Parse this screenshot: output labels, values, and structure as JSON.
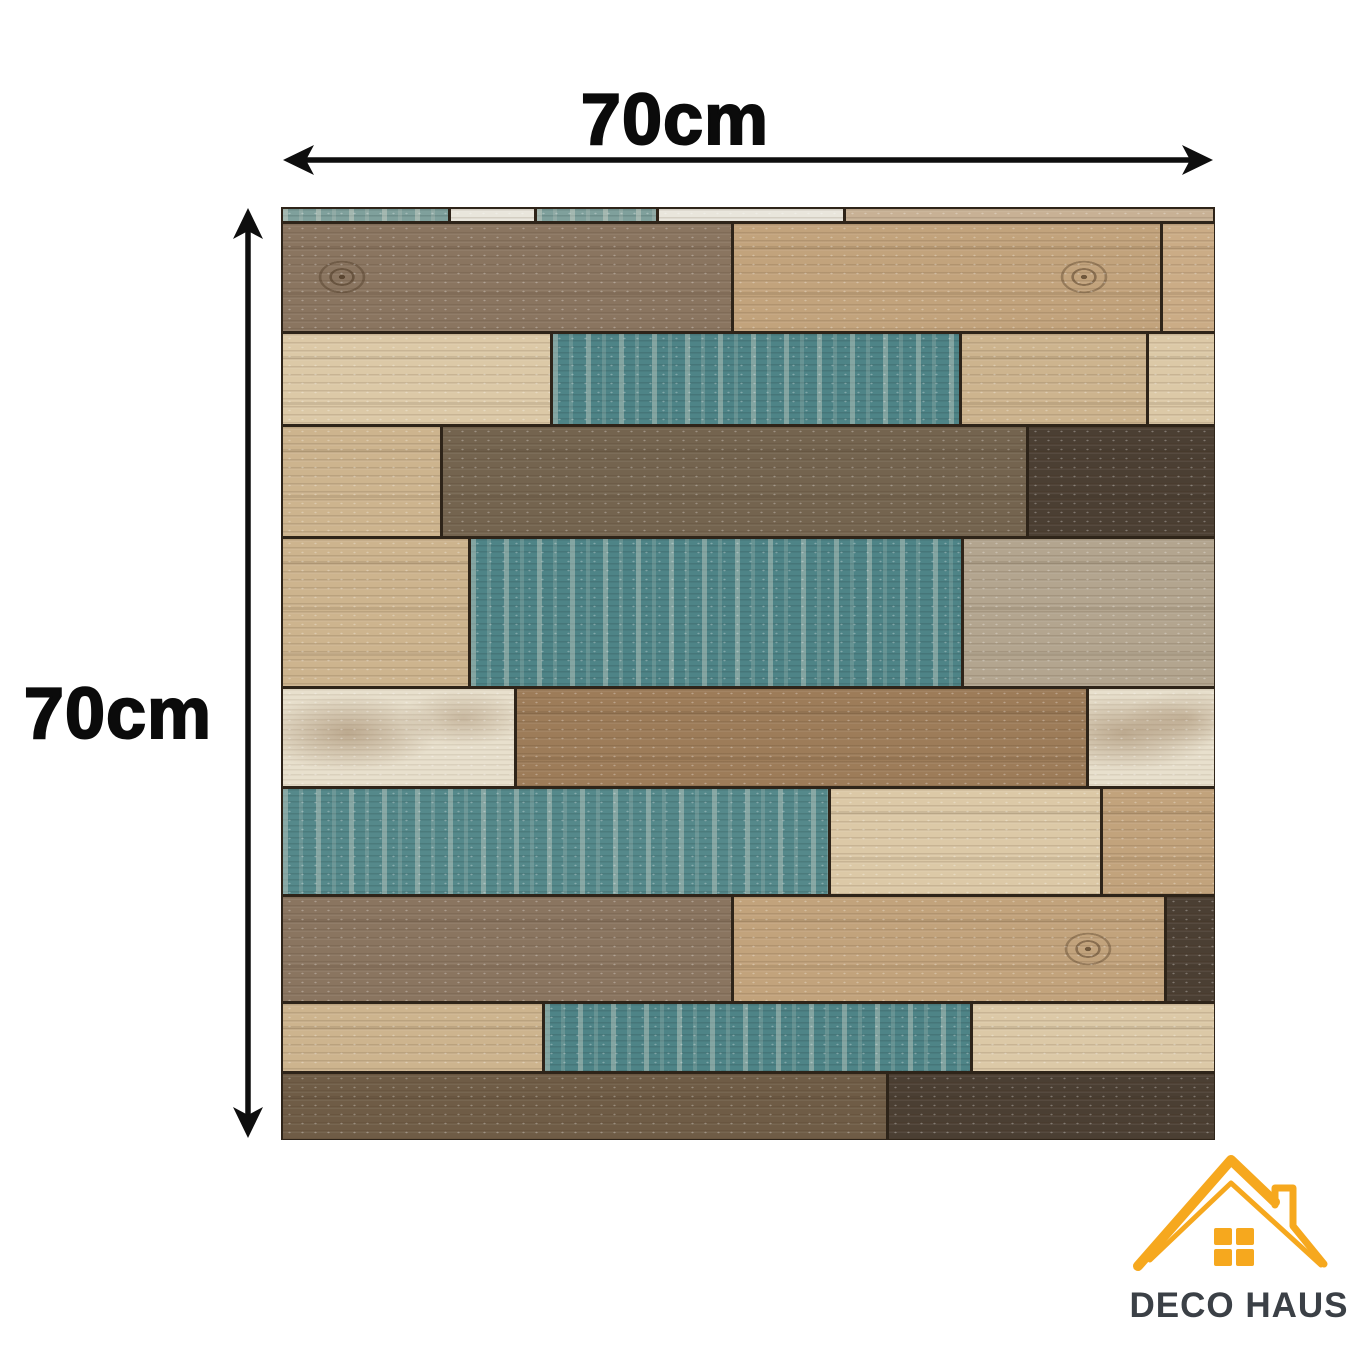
{
  "diagram": {
    "width_label": "70cm",
    "height_label": "70cm",
    "arrow_color": "#0e0e0e",
    "label_color": "#0b0b0b"
  },
  "logo": {
    "brand": "DECO HAUS",
    "house_color": "#F6A81E",
    "text_color": "#3B4046"
  },
  "panel": {
    "seam_color": "#2e2419",
    "tones": {
      "strip_teal": "#7fa09c",
      "strip_white": "#e9e6dc",
      "strip_tan": "#c8b195",
      "graybrown": "#8a7560",
      "tan_knot": "#c2a37c",
      "tan_light": "#cbac86",
      "cream": "#dcc9a7",
      "wheat": "#cdb48e",
      "teal": "#4e8487",
      "teal_light": "#55898b",
      "taupe_dark": "#74644f",
      "espresso": "#4b3f33",
      "white_plank": "#e8e0cd",
      "brown_paint": "#9d7c59",
      "gray_white": "#b3a58f",
      "brown_dark": "#6f5c46"
    },
    "rows": [
      {
        "h": 15,
        "segs": [
          {
            "w": 18,
            "tone": "strip_teal"
          },
          {
            "w": 9,
            "tone": "strip_white"
          },
          {
            "w": 13,
            "tone": "strip_teal"
          },
          {
            "w": 20,
            "tone": "strip_white"
          },
          {
            "w": 40,
            "tone": "strip_tan"
          }
        ]
      },
      {
        "h": 110,
        "segs": [
          {
            "w": 48.5,
            "tone": "graybrown",
            "knot": "left"
          },
          {
            "w": 46,
            "tone": "tan_knot",
            "knot": "right"
          },
          {
            "w": 5.5,
            "tone": "tan_light"
          }
        ]
      },
      {
        "h": 93,
        "segs": [
          {
            "w": 29,
            "tone": "cream"
          },
          {
            "w": 44,
            "tone": "teal"
          },
          {
            "w": 20,
            "tone": "wheat"
          },
          {
            "w": 7,
            "tone": "cream"
          }
        ]
      },
      {
        "h": 112,
        "segs": [
          {
            "w": 17,
            "tone": "wheat"
          },
          {
            "w": 63,
            "tone": "taupe_dark"
          },
          {
            "w": 20,
            "tone": "espresso"
          }
        ]
      },
      {
        "h": 150,
        "segs": [
          {
            "w": 20,
            "tone": "wheat"
          },
          {
            "w": 53,
            "tone": "teal"
          },
          {
            "w": 27,
            "tone": "gray_white"
          }
        ]
      },
      {
        "h": 100,
        "segs": [
          {
            "w": 25,
            "tone": "white_plank"
          },
          {
            "w": 61.5,
            "tone": "brown_paint"
          },
          {
            "w": 13.5,
            "tone": "white_plank"
          }
        ]
      },
      {
        "h": 108,
        "segs": [
          {
            "w": 59,
            "tone": "teal_light"
          },
          {
            "w": 29,
            "tone": "cream"
          },
          {
            "w": 12,
            "tone": "tan_knot"
          }
        ]
      },
      {
        "h": 107,
        "segs": [
          {
            "w": 48.5,
            "tone": "graybrown"
          },
          {
            "w": 46.5,
            "tone": "tan_knot",
            "knot": "right"
          },
          {
            "w": 5,
            "tone": "espresso"
          }
        ]
      },
      {
        "h": 70,
        "segs": [
          {
            "w": 28,
            "tone": "wheat"
          },
          {
            "w": 46,
            "tone": "teal"
          },
          {
            "w": 26,
            "tone": "cream"
          }
        ]
      },
      {
        "h": 68,
        "segs": [
          {
            "w": 65,
            "tone": "brown_dark"
          },
          {
            "w": 35,
            "tone": "espresso"
          }
        ]
      }
    ]
  }
}
